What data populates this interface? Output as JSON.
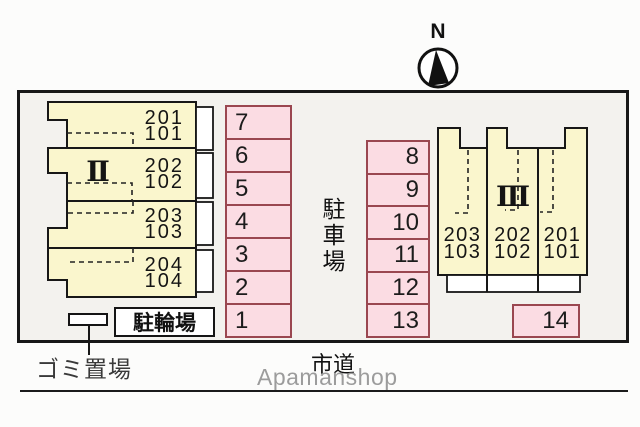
{
  "compass": {
    "label": "N"
  },
  "buildings": {
    "b2": {
      "label": "Ⅱ",
      "units": [
        {
          "upper": "201",
          "lower": "101"
        },
        {
          "upper": "202",
          "lower": "102"
        },
        {
          "upper": "203",
          "lower": "103"
        },
        {
          "upper": "204",
          "lower": "104"
        }
      ]
    },
    "b3": {
      "label": "Ⅲ",
      "units": [
        {
          "upper": "203",
          "lower": "103"
        },
        {
          "upper": "202",
          "lower": "102"
        },
        {
          "upper": "201",
          "lower": "101"
        }
      ]
    }
  },
  "parking": {
    "area_label": "駐車場",
    "left_spaces": [
      "7",
      "6",
      "5",
      "4",
      "3",
      "2",
      "1"
    ],
    "middle_spaces": [
      "8",
      "9",
      "10",
      "11",
      "12",
      "13"
    ],
    "corner_space": "14"
  },
  "facilities": {
    "bicycle_parking": "駐輪場",
    "garbage_area": "ゴミ置場"
  },
  "road": {
    "label": "市道"
  },
  "watermark": {
    "text": "Apamanshop"
  },
  "colors": {
    "building_fill": "#faf6cd",
    "parking_fill": "#fbdce3",
    "parking_border": "#9a4750",
    "outline": "#171717",
    "watermark_gray": "#9c9c9c"
  }
}
